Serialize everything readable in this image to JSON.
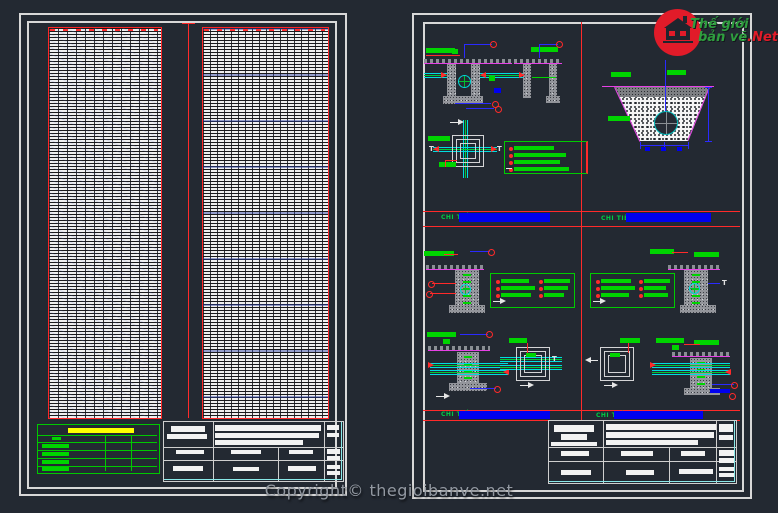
{
  "canvas": {
    "background": "#232932"
  },
  "branding": {
    "logo": {
      "line1": "Thế giới",
      "line2": "bản vẽ",
      "suffix": ".Net",
      "circle_color": "#e11b29",
      "text_color": "#2f9e3f"
    },
    "copyright": "Copyright© thegioibanve.net"
  },
  "right_sheet": {
    "bands": [
      {
        "left_label": "CHI TIẾT",
        "right_label": "CHI TIẾT"
      },
      {
        "left_label": "CHI TIẾT",
        "right_label": "CHI TIẾT"
      }
    ]
  },
  "colors": {
    "red": "#ff2a2a",
    "green": "#00d400",
    "cyan": "#00dde0",
    "blue": "#0000ee",
    "magenta": "#e641e6",
    "yellow": "#ffff00",
    "sheet_border": "#d8d8d8",
    "title_block_accent": "#8ae8e8",
    "table_border": "#ff2626"
  }
}
